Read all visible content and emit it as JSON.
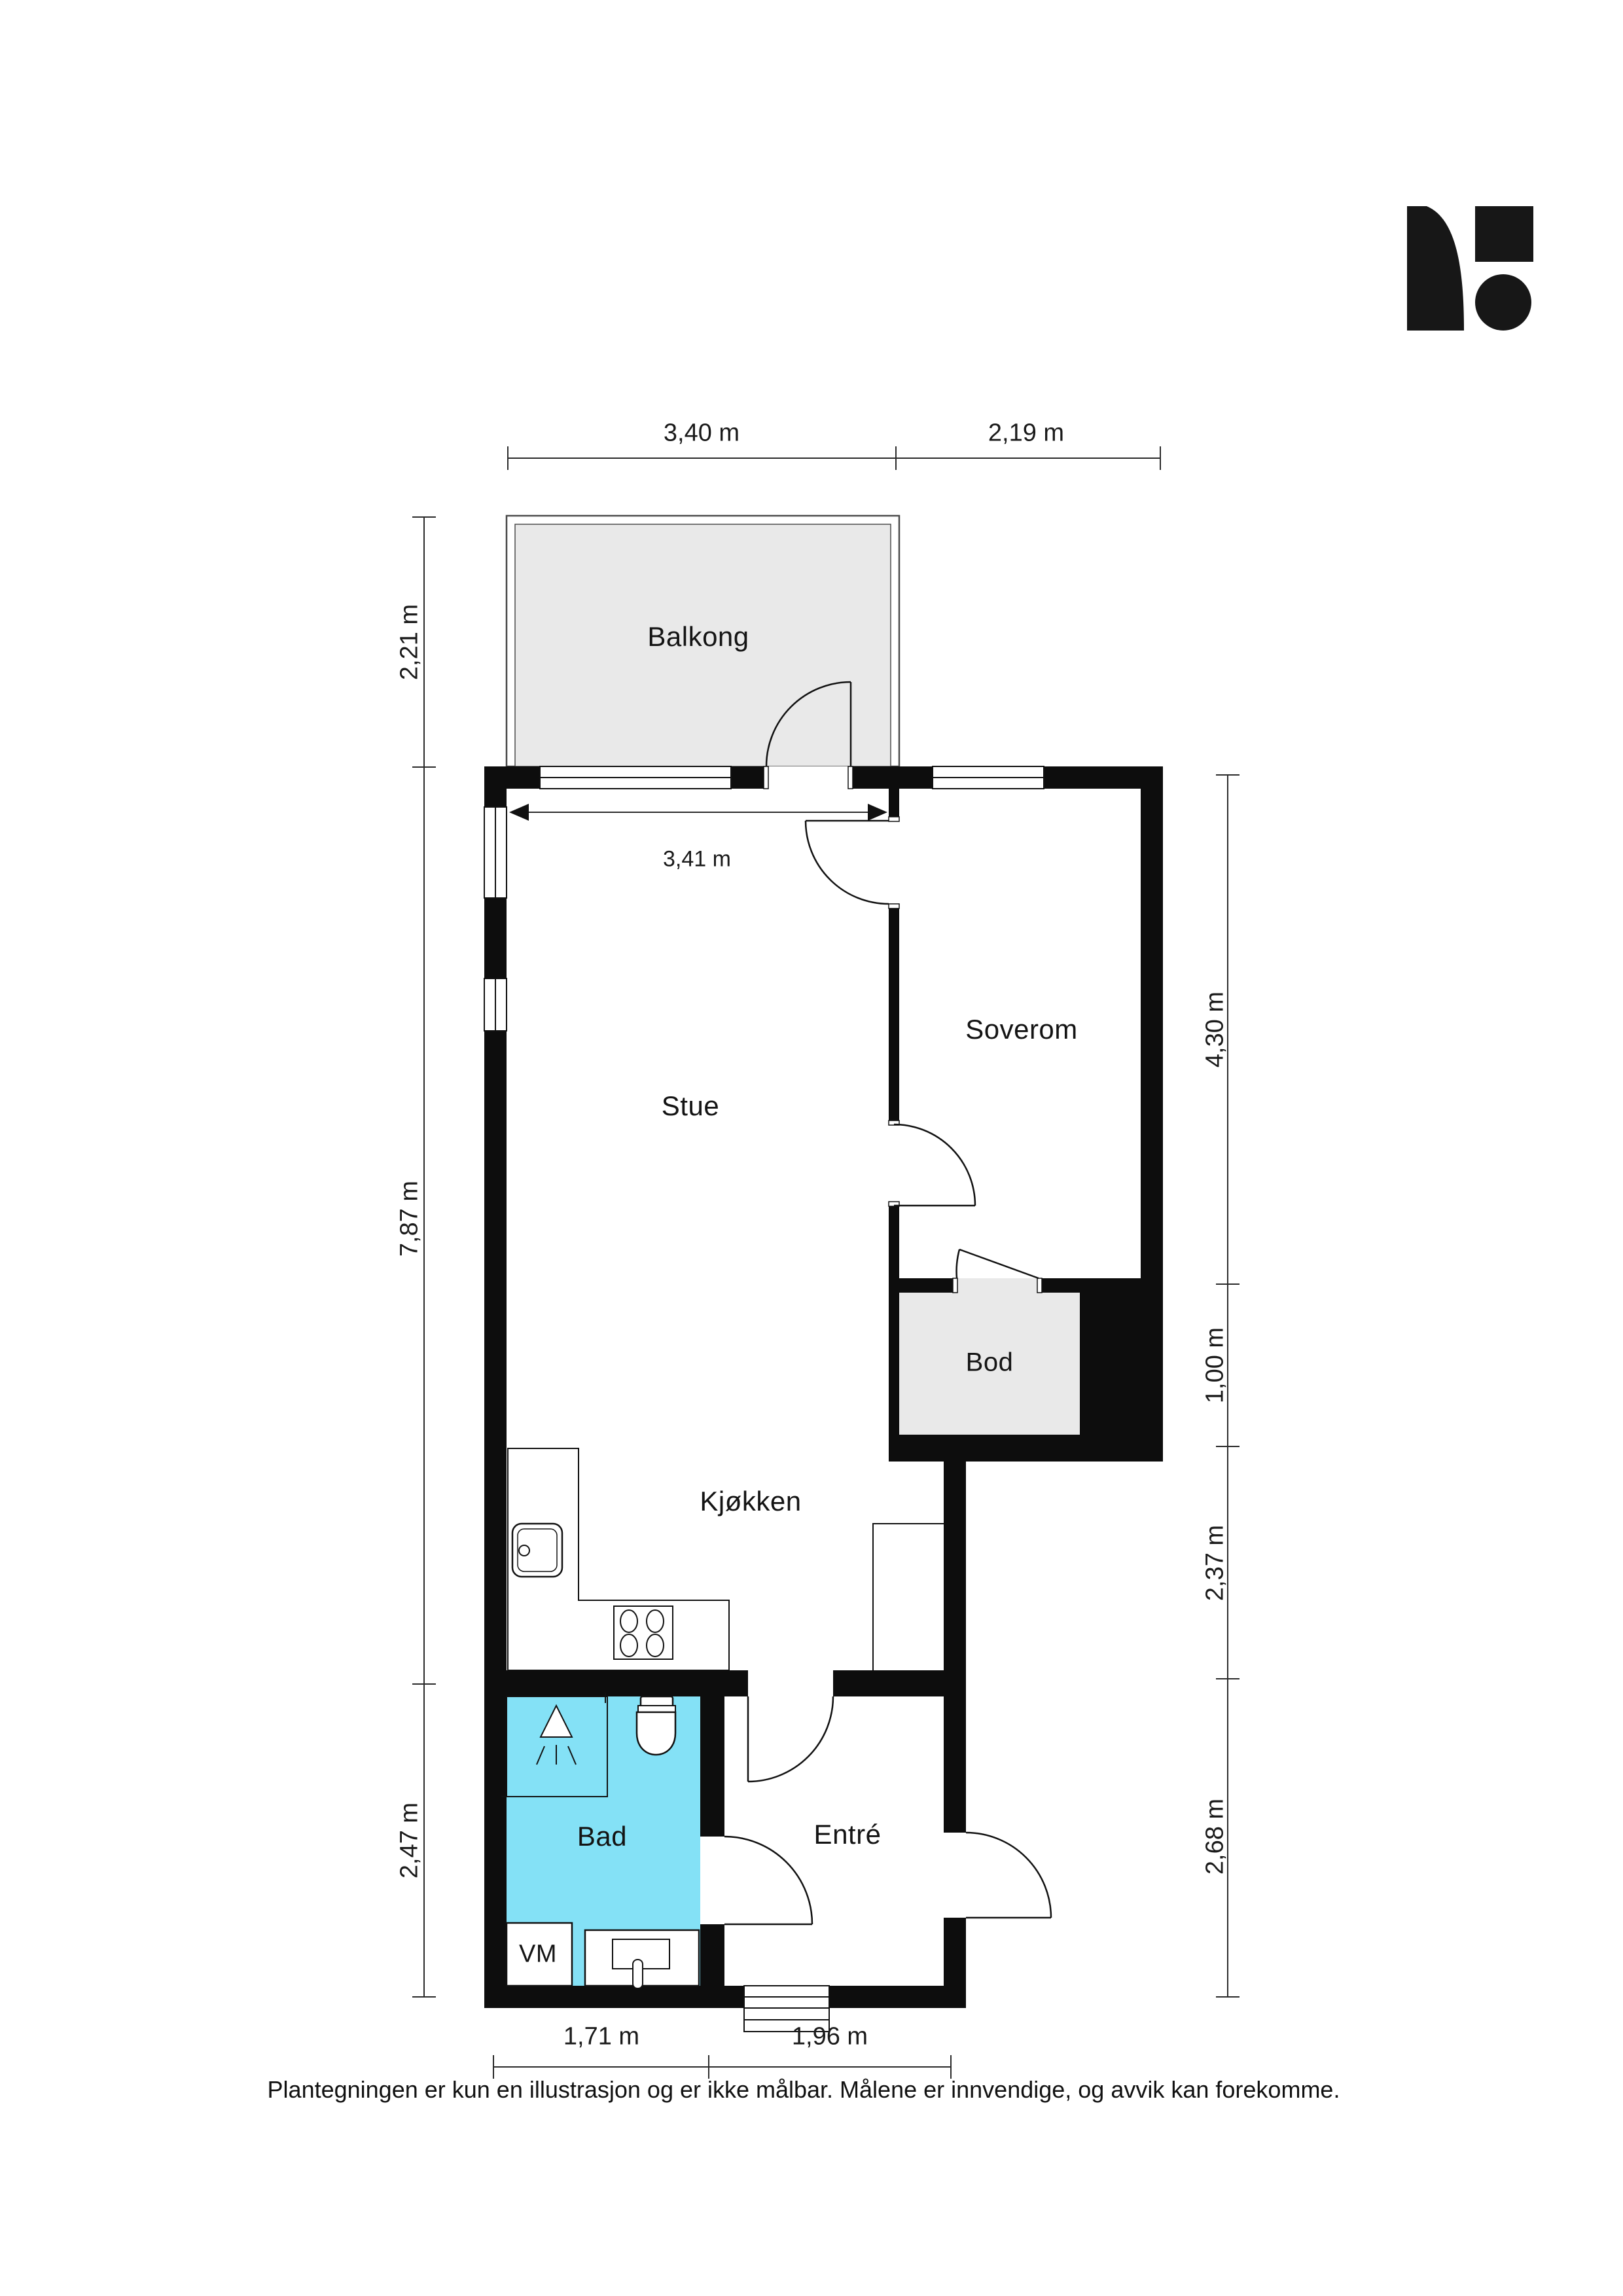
{
  "title": "Plantegning",
  "rooms": {
    "balkong": "Balkong",
    "stue": "Stue",
    "soverom": "Soverom",
    "bod": "Bod",
    "kjokken": "Kjøkken",
    "bad": "Bad",
    "entre": "Entré"
  },
  "fixtures": {
    "washing_machine_label": "VM"
  },
  "dimensions": {
    "top": [
      "3,40 m",
      "2,19 m"
    ],
    "internal_width": "3,41 m",
    "left": [
      "2,21 m",
      "7,87 m",
      "2,47 m"
    ],
    "right": [
      "4,30 m",
      "1,00 m",
      "2,37 m",
      "2,68 m"
    ],
    "bottom": [
      "1,71 m",
      "1,96 m"
    ]
  },
  "footer": {
    "disclaimer": "Plantegningen er kun en illustrasjon og er ikke målbar. Målene er innvendige, og avvik kan forekomme."
  },
  "colors": {
    "wall": "#0d0d0d",
    "balcony_fill": "#e9e9e9",
    "bod_fill": "#e9e9e9",
    "bathroom_fill": "#84e1f6",
    "dimension_line": "#2b2b2b",
    "logo": "#171717"
  }
}
